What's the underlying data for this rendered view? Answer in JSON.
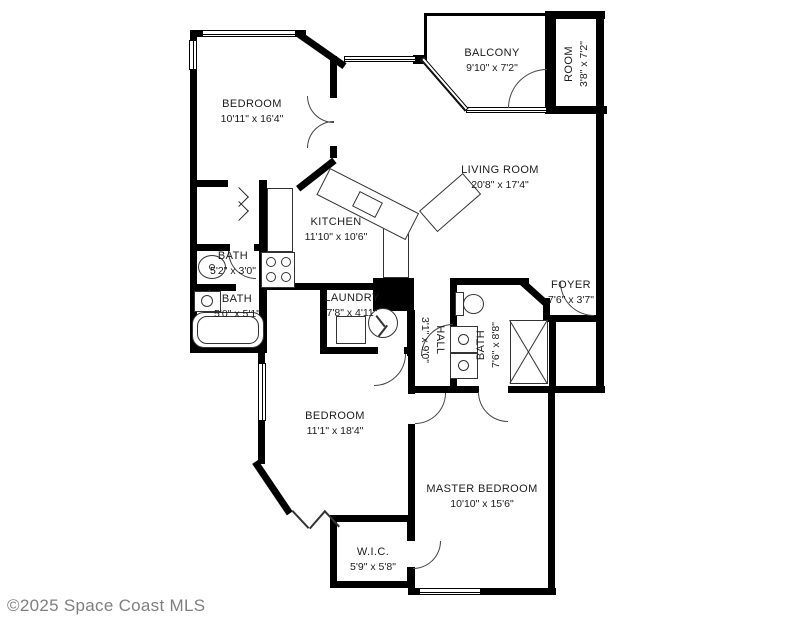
{
  "colors": {
    "wall": "#000000",
    "text": "#1c1c1c",
    "copyright": "#7f7f7f",
    "background": "#ffffff"
  },
  "rooms": [
    {
      "name": "BEDROOM",
      "dims": "10'11\" x 16'4\""
    },
    {
      "name": "BALCONY",
      "dims": "9'10\" x 7'2\""
    },
    {
      "name": "ROOM",
      "dims": "3'8\" x 7'2\""
    },
    {
      "name": "LIVING ROOM",
      "dims": "20'8\" x 17'4\""
    },
    {
      "name": "KITCHEN",
      "dims": "11'10\" x 10'6\""
    },
    {
      "name": "BATH",
      "dims": "5'2\" x 3'0\""
    },
    {
      "name": "BATH",
      "dims": "5'0\" x 5'1\""
    },
    {
      "name": "LAUNDRY",
      "dims": "7'8\" x 4'11\""
    },
    {
      "name": "HALL",
      "dims": "3'1\" x 9'0\""
    },
    {
      "name": "FOYER",
      "dims": "7'6\" x 3'7\""
    },
    {
      "name": "BATH",
      "dims": "7'6\" x 8'8\""
    },
    {
      "name": "BEDROOM",
      "dims": "11'1\" x 18'4\""
    },
    {
      "name": "MASTER BEDROOM",
      "dims": "10'10\" x 15'6\""
    },
    {
      "name": "W.I.C.",
      "dims": "5'9\" x 5'8\""
    }
  ],
  "footer": {
    "copyright": "©2025 Space Coast MLS"
  }
}
